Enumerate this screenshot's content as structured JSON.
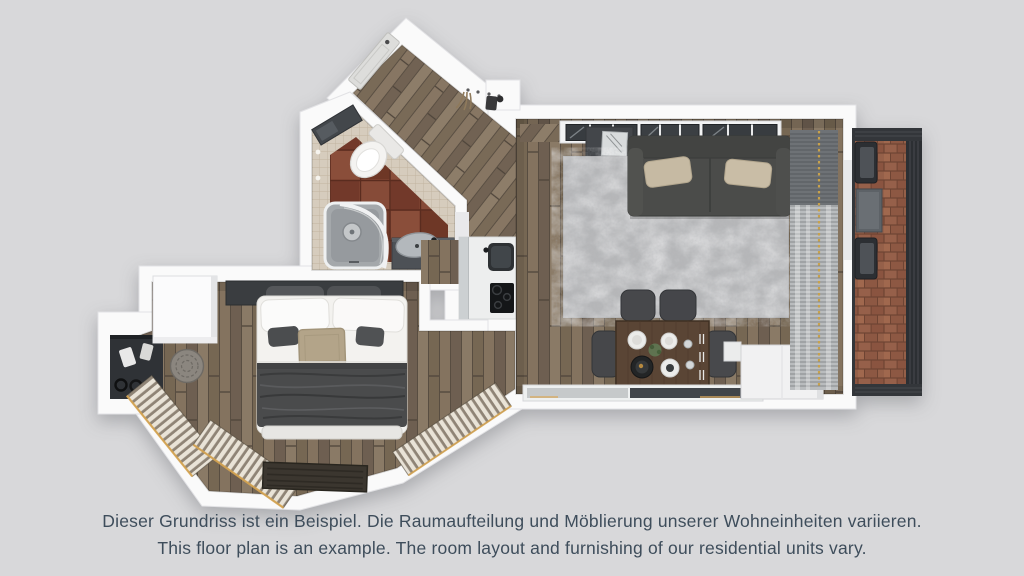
{
  "page": {
    "background_color": "#d8d8da"
  },
  "caption": {
    "german": "Dieser Grundriss ist ein Beispiel. Die Raumaufteilung und Möblierung unserer Wohneinheiten variieren.",
    "english": "This floor plan is an example. The room layout and furnishing of our residential units vary.",
    "text_color": "#3e4d5b"
  },
  "floor_plan": {
    "type": "3d-top-down-apartment-floor-plan",
    "rooms": [
      "entry-hall",
      "bathroom",
      "bedroom",
      "kitchenette",
      "living-dining-room",
      "balcony"
    ],
    "furnishings": [
      "entry-door",
      "coat-hooks",
      "toilet",
      "shower",
      "washbasin",
      "bathroom-mirror-cabinet",
      "wardrobe-niche",
      "closet",
      "double-bed",
      "pouf",
      "radiator-benches",
      "doormat",
      "kitchen-counter",
      "kitchen-sink",
      "cooktop",
      "tv-sideboard",
      "sofa",
      "sofa-cushions",
      "rug",
      "dining-table",
      "dining-chairs",
      "window-front",
      "curtains",
      "sideboard",
      "balcony-chairs",
      "balcony-table",
      "balcony-railing"
    ],
    "colors": {
      "walls": "#fafafa",
      "wood_floor": "#7b6b5a",
      "terracotta_tile": "#7c4130",
      "mosaic_tile": "#d6ccbd",
      "brick": "#8a5440",
      "sofa": "#4b4c4a",
      "rug": "#b6b7b9",
      "gold_accent": "#c8a24c"
    }
  }
}
